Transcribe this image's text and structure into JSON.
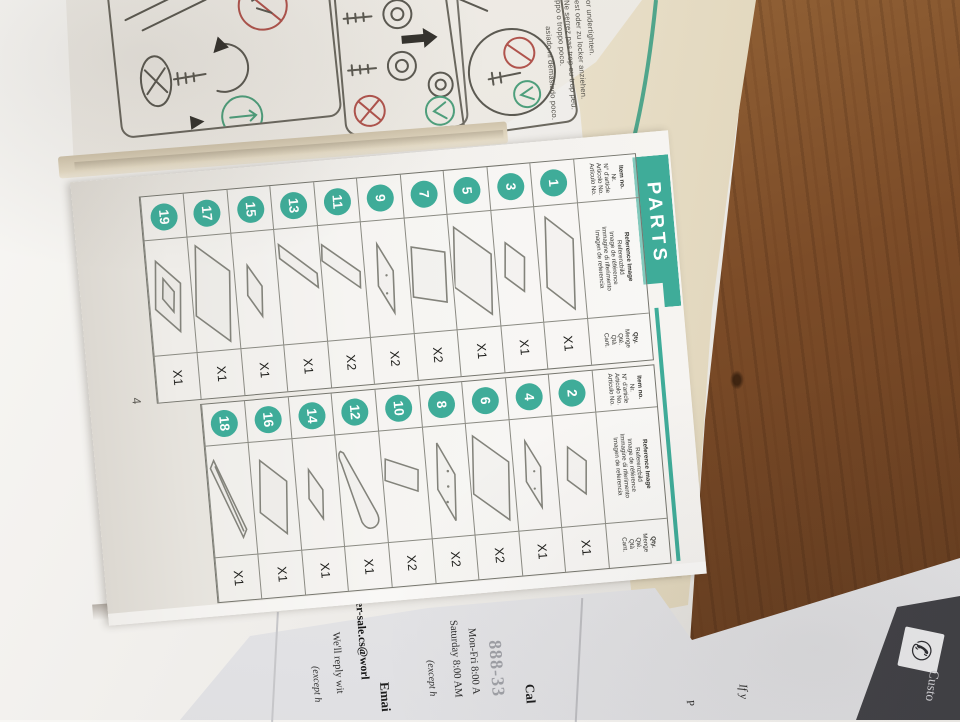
{
  "colors": {
    "teal": "#3fac99",
    "wood": "#7c4d2a",
    "card_dark": "#4a4a4f"
  },
  "icons": {
    "phone": "✆"
  },
  "warning_page": {
    "lines": [
      "or undertighten.",
      "est oder zu locker anziehen.",
      "Ne serrez pas trop ou trop peu.",
      "ppo o troppo poco.",
      "asiado ni demasiado poco."
    ]
  },
  "parts_page": {
    "banner_label": "PARTS",
    "page_number": "4",
    "header": {
      "item_no": [
        "Item no.",
        "Nr.",
        "N° d'article",
        "Articolo No.",
        "Artículo No."
      ],
      "reference": [
        "Reference Image",
        "Referenzbild",
        "Image de référence",
        "Immagine di riferimento",
        "Imagen de referencia"
      ],
      "qty": [
        "Qty.",
        "Menge",
        "Qté.",
        "Qtà",
        "Cant."
      ]
    },
    "tables": [
      {
        "name": "odd-items",
        "items": [
          {
            "no": "1",
            "qty": "X1",
            "shape": "panel-wide"
          },
          {
            "no": "3",
            "qty": "X1",
            "shape": "panel-small"
          },
          {
            "no": "5",
            "qty": "X1",
            "shape": "panel-tall"
          },
          {
            "no": "7",
            "qty": "X2",
            "shape": "panel-upright"
          },
          {
            "no": "9",
            "qty": "X2",
            "shape": "panel-flat"
          },
          {
            "no": "11",
            "qty": "X2",
            "shape": "panel-lean"
          },
          {
            "no": "13",
            "qty": "X1",
            "shape": "panel-long"
          },
          {
            "no": "15",
            "qty": "X1",
            "shape": "panel-flat-sm"
          },
          {
            "no": "17",
            "qty": "X1",
            "shape": "panel-large"
          },
          {
            "no": "19",
            "qty": "X1",
            "shape": "panel-cutout"
          }
        ]
      },
      {
        "name": "even-items",
        "items": [
          {
            "no": "2",
            "qty": "X1",
            "shape": "panel-small"
          },
          {
            "no": "4",
            "qty": "X1",
            "shape": "panel-flat"
          },
          {
            "no": "6",
            "qty": "X2",
            "shape": "panel-tall"
          },
          {
            "no": "8",
            "qty": "X2",
            "shape": "panel-holes"
          },
          {
            "no": "10",
            "qty": "X2",
            "shape": "panel-narrow"
          },
          {
            "no": "12",
            "qty": "X1",
            "shape": "board-rounded"
          },
          {
            "no": "14",
            "qty": "X1",
            "shape": "panel-flat-sm"
          },
          {
            "no": "16",
            "qty": "X1",
            "shape": "panel-mid"
          },
          {
            "no": "18",
            "qty": "X1",
            "shape": "rail"
          }
        ]
      }
    ]
  },
  "service_card": {
    "call_heading": "Cal",
    "phone_number": "888-33",
    "hours_weekday": "Mon-Fri 8:00 A",
    "hours_saturday": "Saturday 8:00 AM",
    "hours_note": "(except h",
    "email_heading": "Emai",
    "email_address": "er-sale.cs@worl",
    "email_reply": "We'll reply wit",
    "email_note": "(except h",
    "intro_fragment": "If y",
    "page_fragment": "P",
    "dark_panel_label": "Custo"
  }
}
